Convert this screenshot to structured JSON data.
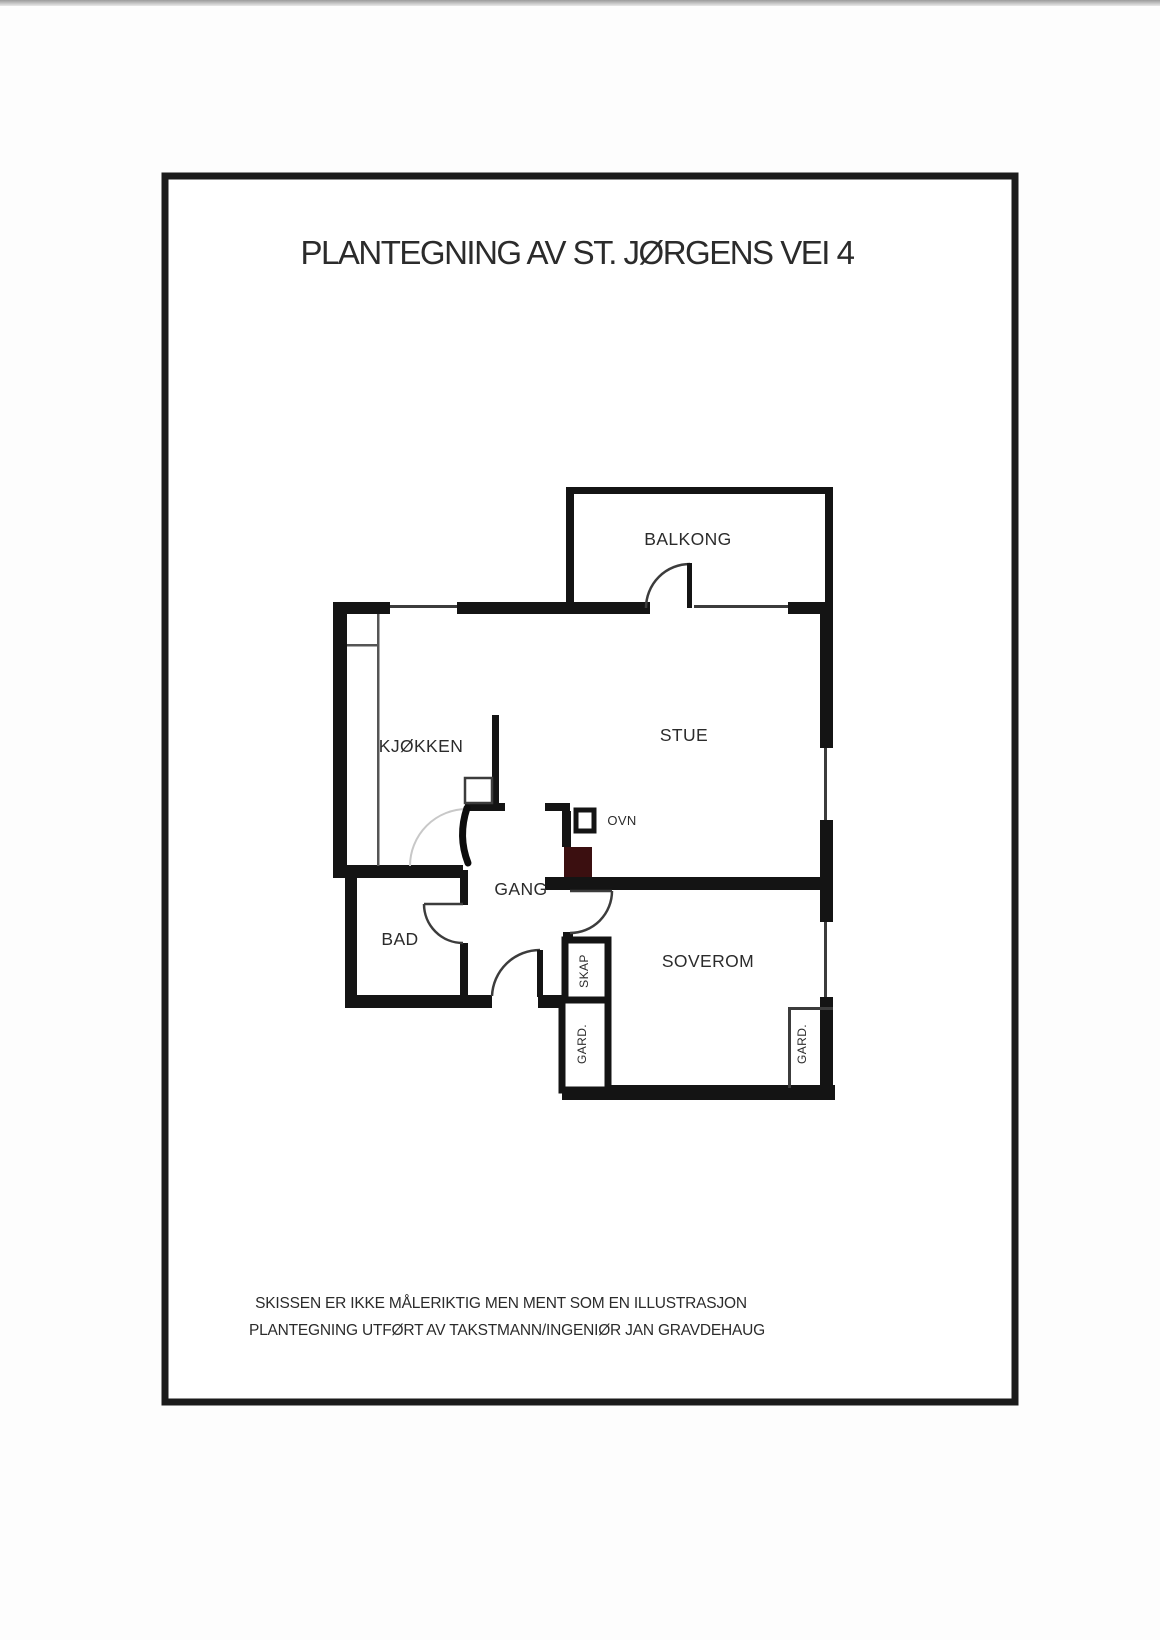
{
  "page": {
    "title": "PLANTEGNING AV ST. JØRGENS VEI 4"
  },
  "rooms": {
    "balcony": {
      "label": "BALKONG"
    },
    "living": {
      "label": "STUE"
    },
    "kitchen": {
      "label": "KJØKKEN"
    },
    "hall": {
      "label": "GANG"
    },
    "bath": {
      "label": "BAD"
    },
    "bedroom": {
      "label": "SOVEROM"
    }
  },
  "fixtures": {
    "oven": {
      "label": "OVN"
    },
    "closet": {
      "label": "SKAP"
    },
    "wardrobe_left": {
      "label": "GARD."
    },
    "wardrobe_right": {
      "label": "GARD."
    }
  },
  "footer": {
    "line1": "SKISSEN ER IKKE MÅLERIKTIG MEN MENT SOM EN ILLUSTRASJON",
    "line2": "PLANTEGNING UTFØRT AV TAKSTMANN/INGENIØR JAN GRAVDEHAUG"
  },
  "colors": {
    "wall": "#141414",
    "chimney": "#3b0f10",
    "thin_line": "#3c3c3c",
    "faint_arc": "#c8c8c8",
    "text": "#2b2b2b"
  }
}
